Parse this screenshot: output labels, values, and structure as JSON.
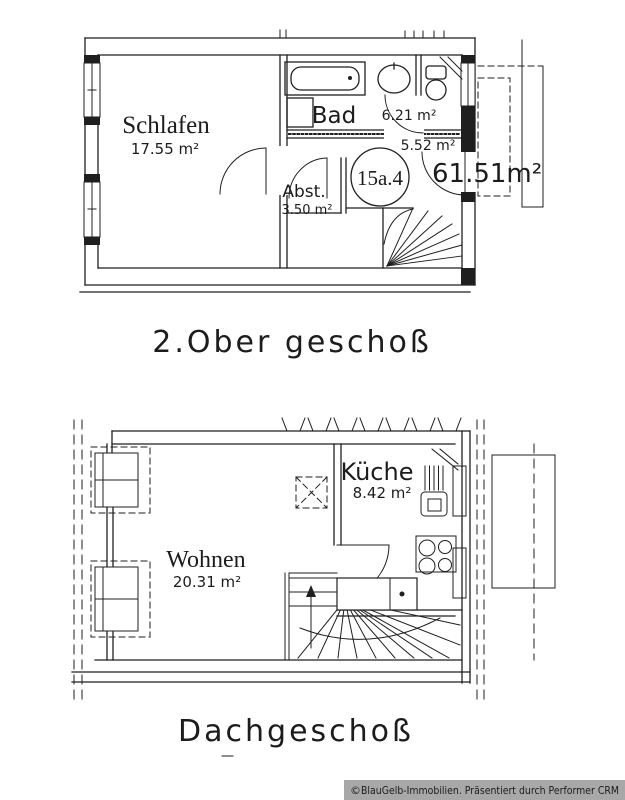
{
  "colors": {
    "ink": "#1f1f1f",
    "paper": "#ffffff",
    "watermark_bg": "#a8a8a8"
  },
  "upper_plan": {
    "caption": "2.Ober geschoß",
    "unit_circle_label": "15a.4",
    "total_area": "61.51m²",
    "rooms": {
      "schlafen": {
        "name": "Schlafen",
        "area": "17.55 m²"
      },
      "bad": {
        "name": "Bad",
        "area": "6.21 m²"
      },
      "diele": {
        "area": "5.52 m²"
      },
      "abstell": {
        "name": "Abst.",
        "area": "3.50 m²"
      }
    }
  },
  "lower_plan": {
    "caption": "Dachgeschoß",
    "rooms": {
      "wohnen": {
        "name": "Wohnen",
        "area": "20.31 m²"
      },
      "kueche": {
        "name": "Küche",
        "area": "8.42 m²"
      }
    }
  },
  "watermark": {
    "symbol": "©",
    "text": "BlauGelb-Immobilien. Präsentiert durch Performer CRM"
  }
}
